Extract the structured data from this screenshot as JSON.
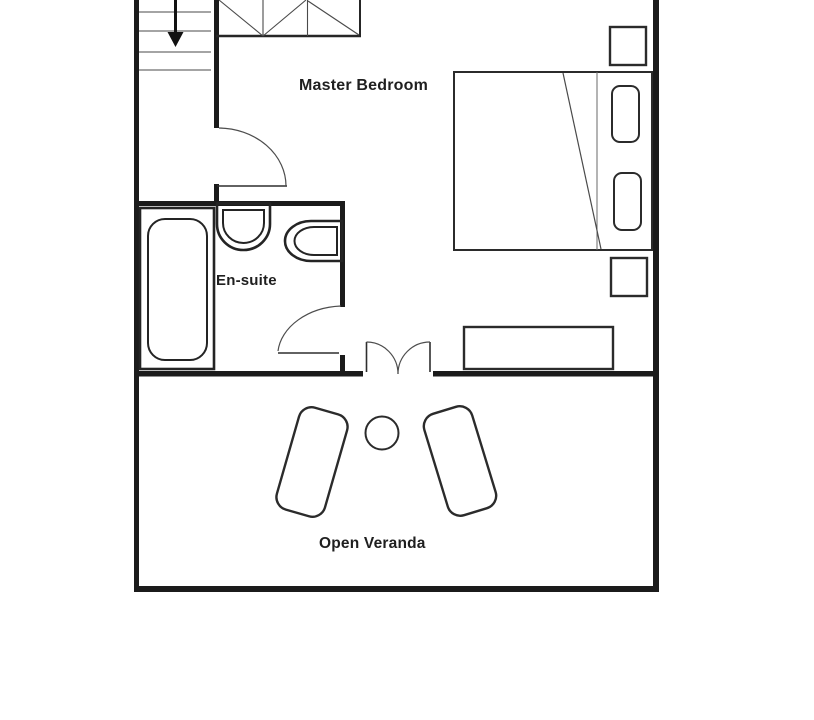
{
  "page": {
    "background": "#ffffff"
  },
  "plan": {
    "type": "floor-plan",
    "rooms": [
      {
        "id": "master-bedroom",
        "label": "Master Bedroom"
      },
      {
        "id": "en-suite",
        "label": "En-suite"
      },
      {
        "id": "open-veranda",
        "label": "Open Veranda"
      }
    ],
    "fixtures": [
      "staircase-down-arrow",
      "wardrobe",
      "double-bed",
      "bed-pillow-top",
      "bed-pillow-bottom",
      "nightstand-top",
      "nightstand-bottom",
      "bench",
      "bathtub",
      "wash-basin",
      "toilet",
      "lounge-chair-left",
      "lounge-chair-right",
      "round-table"
    ],
    "doors": [
      {
        "id": "bedroom-entry-door",
        "type": "single-swing"
      },
      {
        "id": "ensuite-door",
        "type": "single-swing"
      },
      {
        "id": "veranda-double-door",
        "type": "double-swing"
      }
    ],
    "colors": {
      "wall": "#1b1b1b",
      "line": "#3f3f3f",
      "background": "#ffffff",
      "text": "#1f1f1f"
    }
  }
}
